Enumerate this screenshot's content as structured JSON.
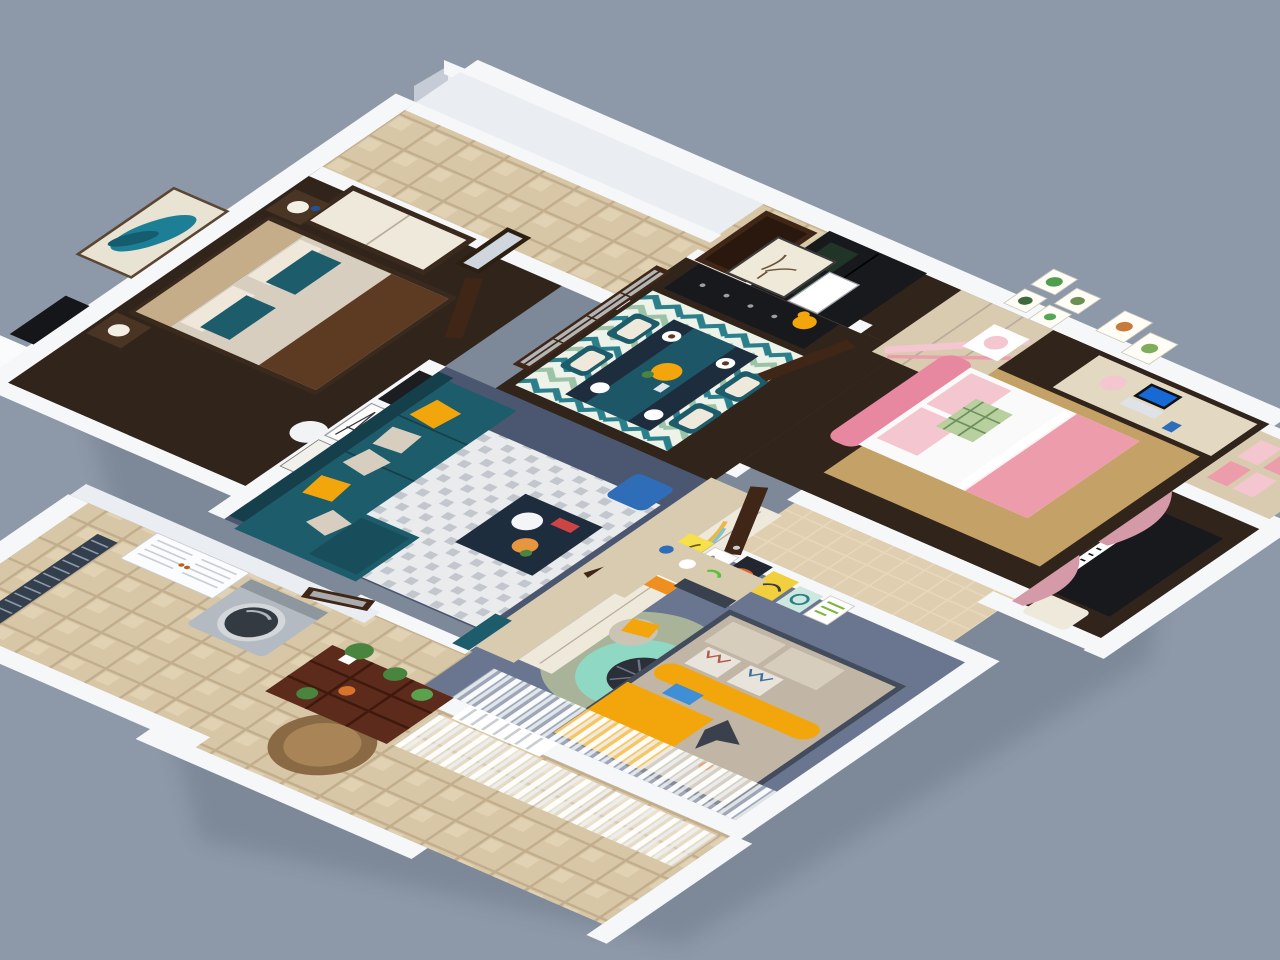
{
  "scene": {
    "title": "3D isometric cutaway floor plan render of a three-bedroom apartment",
    "view": "axonometric top-down cutaway, walls cut low, on plain blue-gray backdrop",
    "visible_text": "none (decor posters contain illegible micro-text only)"
  },
  "palette": {
    "bg": "#8d98a8",
    "wallTop": "#f6f7f9",
    "wallFace": "#eaedf1",
    "wallShade": "#c6ccd5",
    "woodFloor": "#31241b",
    "livingFloor": "#4b5770",
    "boyFloor": "#6a7690",
    "tile": "#d8c7a6",
    "tileLight": "#e7d8bb",
    "tileLine": "#c2ae8c",
    "rugLight": "#eaebed",
    "rugCheck": "#c2c6cd",
    "tanRug": "#c4a267",
    "teal": "#1d5c6b",
    "tealDark": "#143f4b",
    "yellow": "#f2a60c",
    "beige": "#d8cec0",
    "navy": "#1e2d3e",
    "blue": "#2f6db8",
    "screenBlue": "#1769d6",
    "doorBrown": "#3f2617",
    "doorDark": "#2a170d",
    "black": "#17191d",
    "pink": "#ec9cab",
    "pinkLight": "#f4c6cf",
    "pinkDeep": "#e887a0",
    "curtainPink": "#d59aa8",
    "woodLight": "#d9cbb0",
    "cream": "#efe9dc",
    "silver": "#b3bac1",
    "green": "#49853e",
    "mint": "#8fd9c4",
    "sage": "#a9b39a",
    "grayBed": "#c1b6a5",
    "bedBase": "#434c5c",
    "rattan": "#8a6a45",
    "chevTeal": "#2a7f8a",
    "chevGreen": "#9cc3a8",
    "chevBg": "#eef3ea"
  },
  "rooms": [
    {
      "id": "master-bedroom",
      "name": "Master bedroom",
      "floor": "dark wood",
      "furniture": [
        "double bed with tan tufted headboard",
        "beige duvet",
        "brown throw",
        "teal accent pillows",
        "two nightstands with lamps",
        "wardrobe with cream doors",
        "teal feather wall art",
        "wall TV",
        "white column lamp",
        "leaning poster frames"
      ]
    },
    {
      "id": "entry-hall",
      "name": "Entry hall",
      "floor": "beige tile",
      "furniture": [
        "full-length mirror",
        "dark entry door",
        "glass-panel sliding door"
      ]
    },
    {
      "id": "dining-room",
      "name": "Dining room",
      "floor": "dark wood",
      "furniture": [
        "black sideboard",
        "antler print art",
        "yellow flower vase",
        "dark dining table with teal runner",
        "four teal chairs",
        "place settings",
        "teal chevron rug"
      ]
    },
    {
      "id": "girls-bedroom",
      "name": "Girl's bedroom",
      "floor": "dark wood",
      "furniture": [
        "pink princess bed",
        "green plaid pillow",
        "white nightstand with pink lamp",
        "desk with laptop (blue screen)",
        "light-wood wardrobe with pink stripes",
        "black display cabinet",
        "wood bookshelf with pink panels",
        "six small wall prints",
        "tan rug"
      ]
    },
    {
      "id": "piano-nook",
      "name": "Piano bay window",
      "floor": "dark wood",
      "furniture": [
        "black upright piano",
        "cream tufted stool",
        "pink drape curtains"
      ]
    },
    {
      "id": "boys-bedroom",
      "name": "Boy's bedroom",
      "floor": "blue-gray",
      "furniture": [
        "gray bed with yellow bolster",
        "yellow blanket",
        "toy fighter jet",
        "poster wall (giraffe, fish, whale, prints)",
        "corner desk",
        "chair with yellow cushion",
        "round sage and mint rug",
        "spoke side table",
        "wardrobe with rainbow and plane print",
        "sheer window curtains"
      ]
    },
    {
      "id": "bathroom",
      "name": "Bathroom (between kids rooms)",
      "floor": "beige tile"
    },
    {
      "id": "living-room",
      "name": "Living room",
      "floor": "dark blue-gray",
      "furniture": [
        "teal L-shaped sectional sofa",
        "yellow and beige cushions",
        "navy coffee table with orange flowers",
        "blue pouf",
        "white geometric rug"
      ]
    },
    {
      "id": "laundry-balcony",
      "name": "Laundry balcony",
      "floor": "beige tile",
      "furniture": [
        "silver washing machine",
        "white louvered cabinet",
        "dark slatted screen",
        "dark balcony door"
      ]
    },
    {
      "id": "terrace-balcony",
      "name": "Terrace balcony",
      "floor": "beige tile",
      "furniture": [
        "dark wood plant shelf with potted plants",
        "round rattan rug",
        "white picket rail with gate",
        "sheer curtains",
        "white railing walls"
      ]
    },
    {
      "id": "master-balcony",
      "name": "Master side balcony",
      "floor": "white ledge",
      "furniture": [
        "AC unit with slats"
      ]
    }
  ]
}
